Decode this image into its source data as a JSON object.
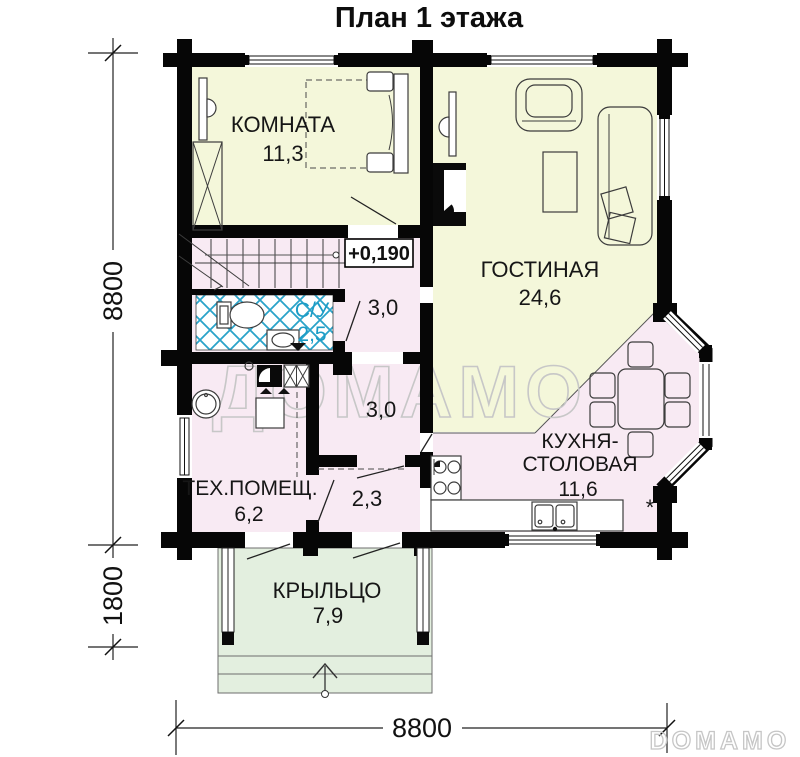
{
  "title": "План 1 этажа",
  "watermark": {
    "center": "ДОМАМО",
    "corner": "DOMAMO"
  },
  "elevation_label": "+0,190",
  "footnote_mark": "*",
  "rooms": {
    "bedroom": {
      "name": "КОМНАТА",
      "area": "11,3"
    },
    "living": {
      "name": "ГОСТИНАЯ",
      "area": "24,6"
    },
    "bathroom": {
      "name": "С/У",
      "area": "2,5"
    },
    "hall_entry": {
      "area": "3,0"
    },
    "hall_mid": {
      "area": "3,0"
    },
    "hall_lower": {
      "area": "2,3"
    },
    "tech": {
      "name": "ТЕХ.ПОМЕЩ.",
      "area": "6,2"
    },
    "kitchen": {
      "name_line1": "КУХНЯ-",
      "name_line2": "СТОЛОВАЯ",
      "area": "11,6"
    },
    "porch": {
      "name": "КРЫЛЬЦО",
      "area": "7,9"
    }
  },
  "dimensions": {
    "side_total": "8800",
    "side_porch": "1800",
    "bottom_total": "8800"
  },
  "colors": {
    "room_main": "#f4f7da",
    "room_service": "#f8eaf3",
    "porch": "#e3efdf",
    "tile": "#2aa3c9",
    "bath_label": "#1b9cc6",
    "wall": "#060606",
    "watermark": "#c7c7c7"
  }
}
